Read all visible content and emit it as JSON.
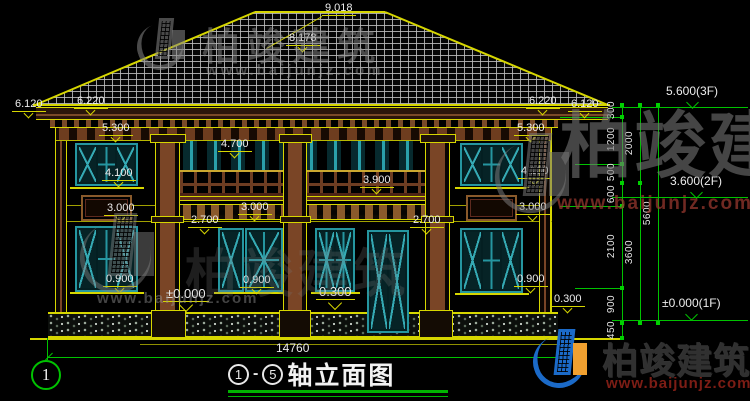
{
  "drawing": {
    "labels": {
      "ridge": "9.018",
      "ridge2": "8.178",
      "left": {
        "eave_out": "6.120",
        "eave_top": "6.220",
        "win_head2": "5.300",
        "win_sill2": "4.100",
        "win_head1": "3.000",
        "win_sill1": "0.900"
      },
      "center": {
        "rail_top": "4.700",
        "balcony": "3.900",
        "band": "3.000",
        "door_head_l": "2.700",
        "door_head_r": "2.700",
        "sill": "0.900",
        "floor": "±0.000",
        "terrace": "0.300"
      },
      "right": {
        "eave_top": "6.220",
        "eave_out": "6.120",
        "win_head2": "5.300",
        "win_sill2": "4.100",
        "win_head1": "3.000",
        "win_sill1": "0.900",
        "plinth": "0.300"
      }
    },
    "chain": {
      "col1": [
        "300",
        "1200",
        "500",
        "600",
        "2100",
        "900",
        "450"
      ],
      "col2": [
        "2000",
        "3600"
      ],
      "col3": [
        "5600"
      ]
    },
    "floor_marks": {
      "f3": "5.600(3F)",
      "f2": "3.600(2F)",
      "f1": "±0.000(1F)"
    },
    "bottom": {
      "total_width": "14760",
      "grid_bubble": "1",
      "axis_from": "1",
      "axis_to": "5",
      "dash": "-",
      "title": "轴立面图"
    }
  },
  "watermark": {
    "name": "柏竣建筑",
    "url": "www.baijunjz.com"
  }
}
